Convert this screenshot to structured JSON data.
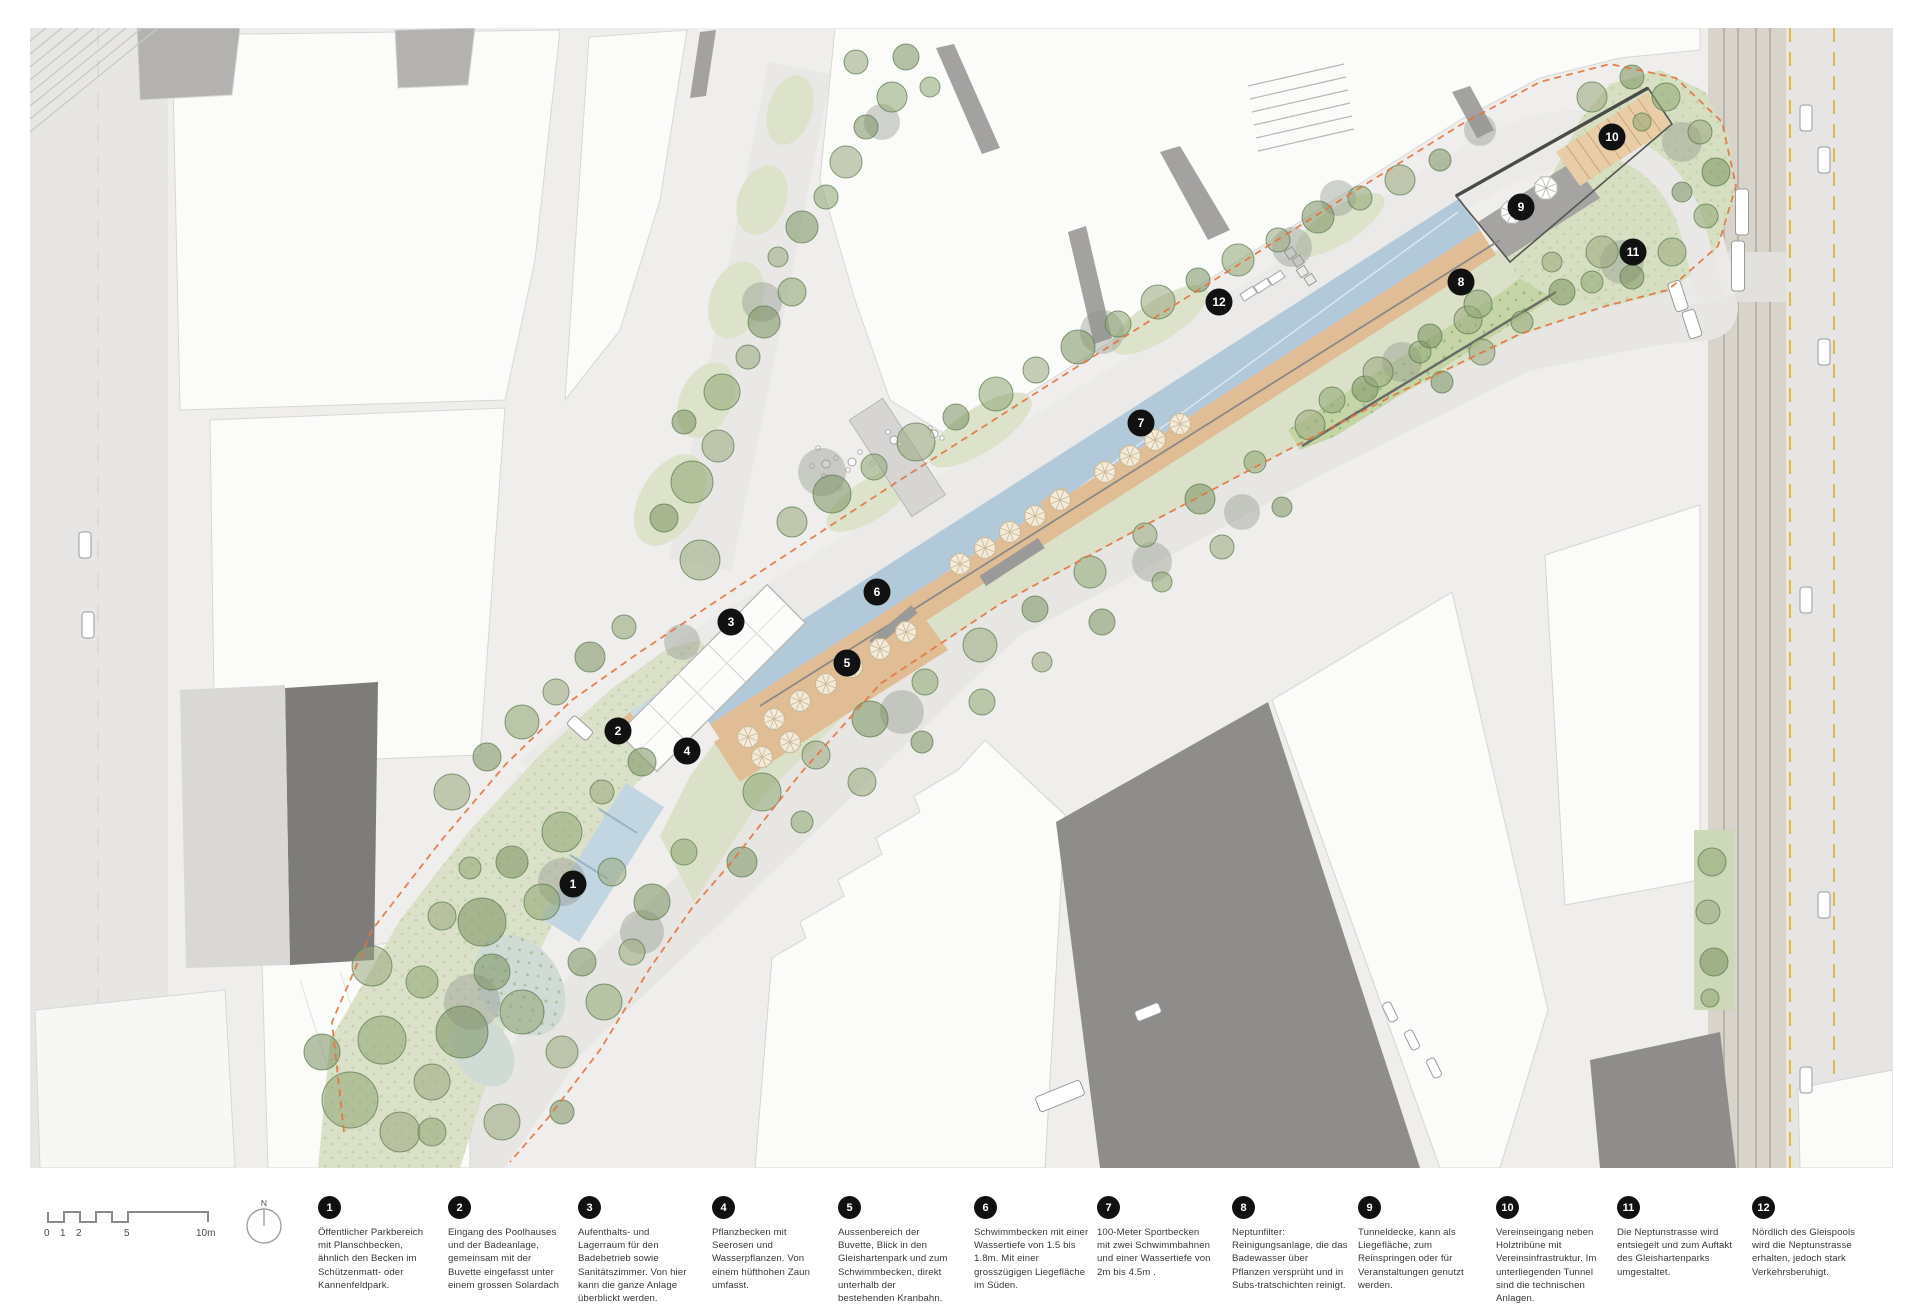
{
  "colors": {
    "pool_blue": "#b2c9da",
    "basin_blue": "#c9dce5",
    "wading_blue": "#c2d6e2",
    "park_green": "#dbe1c8",
    "filter_green": "#c5d5a6",
    "meadow_dot": "#a6bc83",
    "wood_deck": "#e0bd94",
    "tribune_wood": "#e9cda6",
    "tunnel_deck": "#a5a4a2",
    "dark_building": "#8e8d8b",
    "boundary_dash": "#e2743f",
    "rail_yellow": "#ddba49",
    "marker_bg": "#111111",
    "marker_fg": "#ffffff"
  },
  "north": {
    "label": "N"
  },
  "scalebar": {
    "labels": [
      "0",
      "1",
      "2",
      "5",
      "10m"
    ]
  },
  "legend": {
    "items": [
      {
        "num": "1",
        "text": "Öffentlicher Parkbereich mit Planschbecken, ähnlich den Becken im Schützenmatt- oder Kannenfeldpark."
      },
      {
        "num": "2",
        "text": "Eingang des Poolhauses und der Badeanlage, gemeinsam mit der Buvette eingefasst unter einem grossen Solardach"
      },
      {
        "num": "3",
        "text": "Aufenthalts- und Lagerraum für den Badebetrieb sowie Sanitätszimmer. Von hier kann die ganze Anlage überblickt werden."
      },
      {
        "num": "4",
        "text": "Pflanzbecken mit Seerosen und Wasserpflanzen. Von einem hüfthohen Zaun umfasst."
      },
      {
        "num": "5",
        "text": "Aussenbereich der Buvette, Blick in den Gleishartenpark und zum Schwimmbecken, direkt unterhalb der bestehenden Kranbahn."
      },
      {
        "num": "6",
        "text": "Schwimmbecken mit einer Wassertiefe von 1.5 bis 1.8m. Mit einer grosszügigen Liegefläche im Süden."
      },
      {
        "num": "7",
        "text": "100-Meter Sportbecken mit zwei Schwimmbahnen und einer Wassertiefe von 2m bis 4.5m ."
      },
      {
        "num": "8",
        "text": "Neptunfilter: Reinigungsanlage, die das Badewasser über Pflanzen versprüht und in Subs-tratschichten reinigt."
      },
      {
        "num": "9",
        "text": "Tunneldecke, kann als Liegefläche, zum Reinspringen oder für Veranstaltungen genutzt werden."
      },
      {
        "num": "10",
        "text": "Vereinseingang neben Holztribüne mit Vereinsinfrastruktur. Im unterliegenden Tunnel sind die technischen Anlagen."
      },
      {
        "num": "11",
        "text": "Die Neptunstrasse wird entsiegelt und zum Auftakt des Gleishartenparks umgestaltet."
      },
      {
        "num": "12",
        "text": "Nördlich des Gleispools wird die Neptunstrasse erhalten, jedoch stark Verkehrsberuhigt."
      }
    ]
  },
  "map_markers": [
    {
      "num": "1",
      "x": 573,
      "y": 884
    },
    {
      "num": "2",
      "x": 618,
      "y": 731
    },
    {
      "num": "3",
      "x": 731,
      "y": 622
    },
    {
      "num": "4",
      "x": 687,
      "y": 751
    },
    {
      "num": "5",
      "x": 847,
      "y": 663
    },
    {
      "num": "6",
      "x": 877,
      "y": 592
    },
    {
      "num": "7",
      "x": 1141,
      "y": 423
    },
    {
      "num": "8",
      "x": 1461,
      "y": 282
    },
    {
      "num": "9",
      "x": 1521,
      "y": 207
    },
    {
      "num": "10",
      "x": 1612,
      "y": 137
    },
    {
      "num": "11",
      "x": 1633,
      "y": 252
    },
    {
      "num": "12",
      "x": 1219,
      "y": 302
    }
  ]
}
